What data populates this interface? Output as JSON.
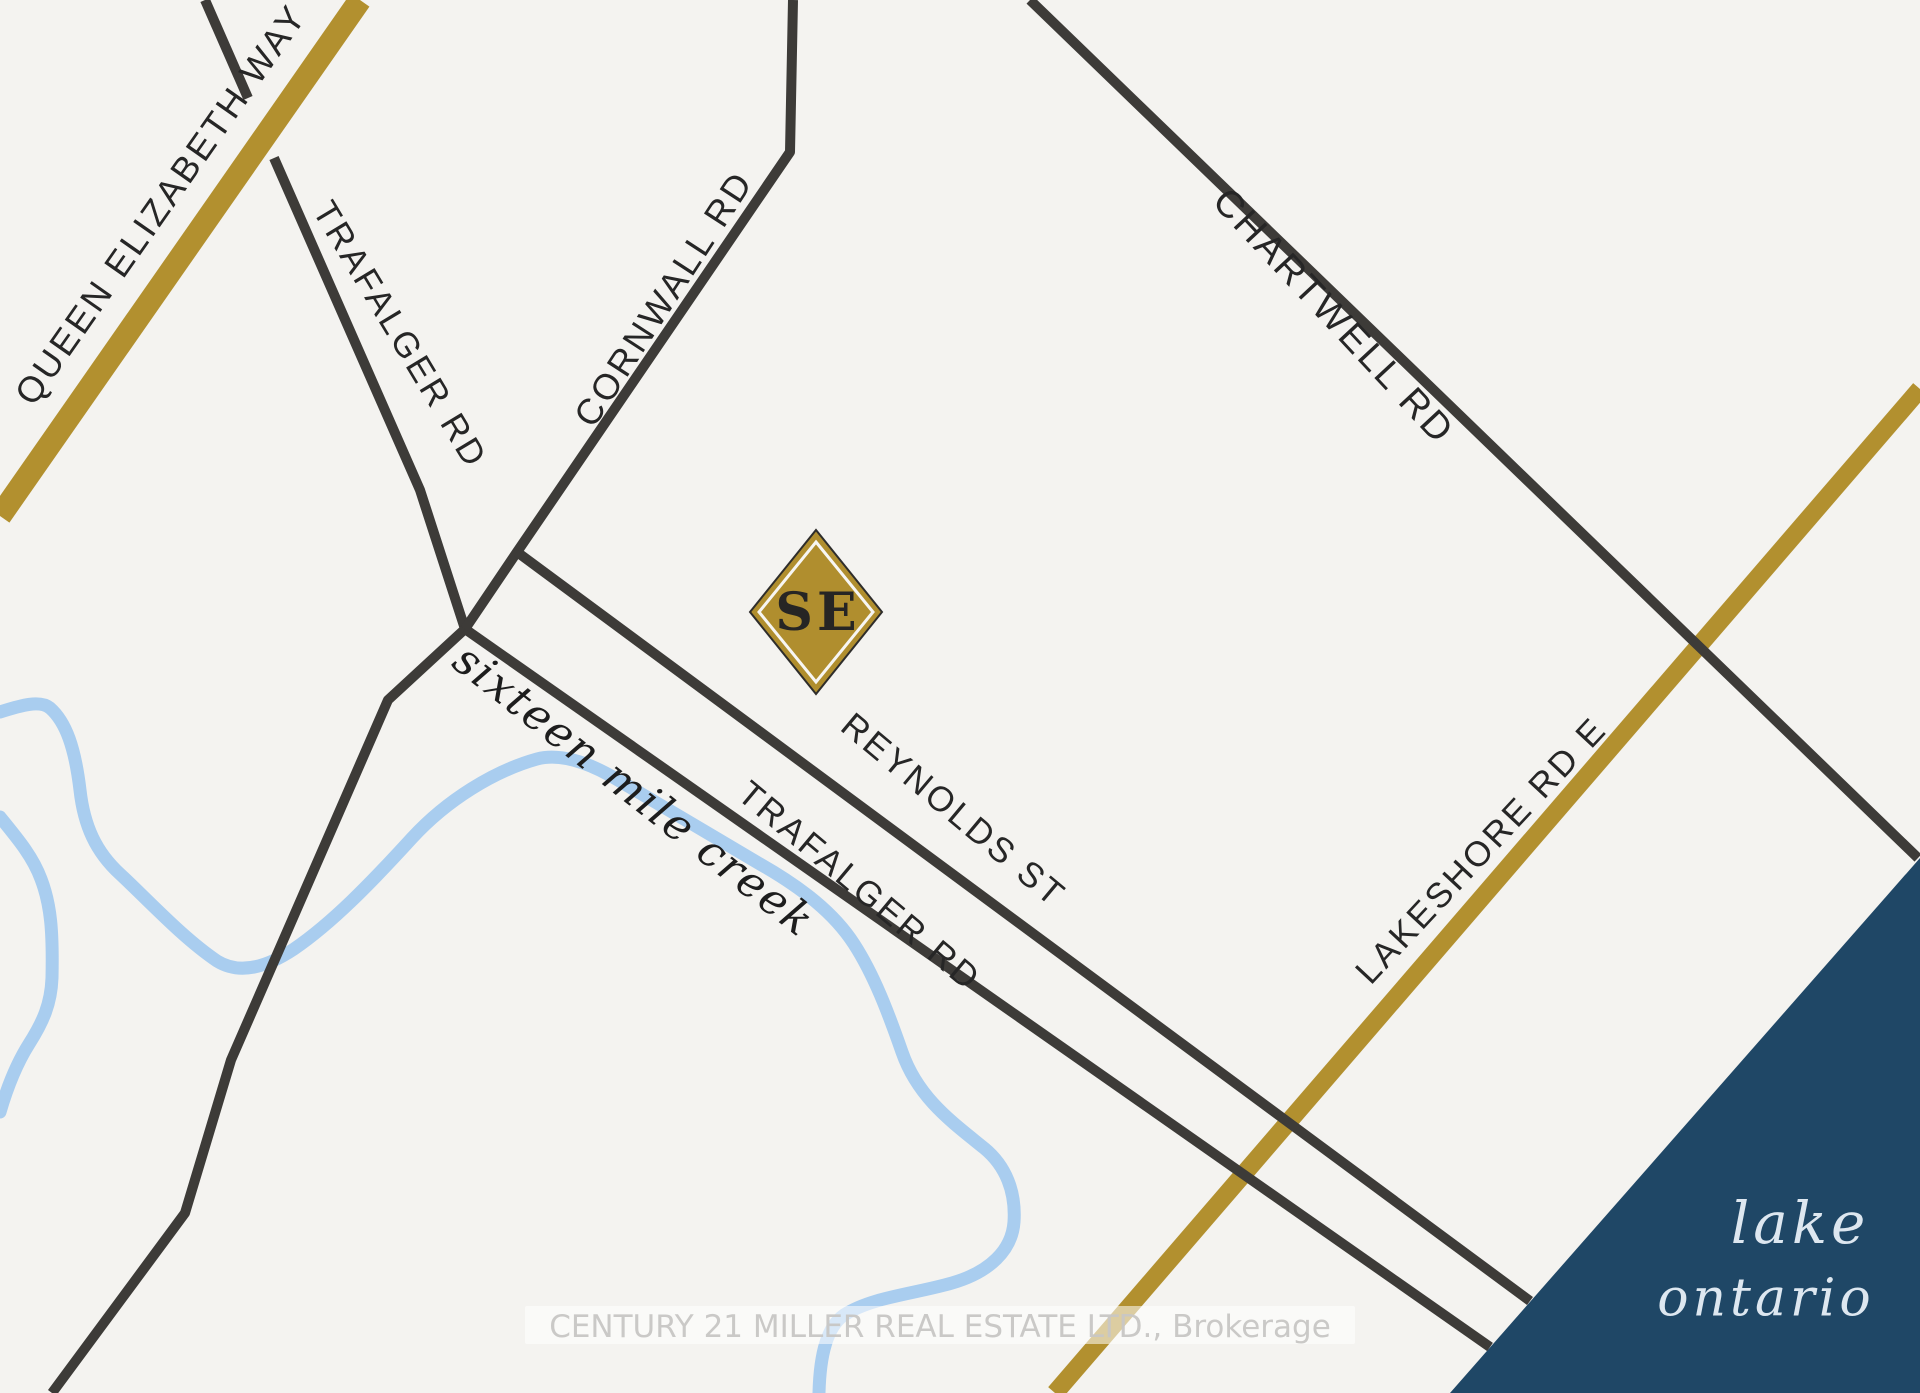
{
  "map": {
    "labels": {
      "qew": "QUEEN ELIZABETH WAY",
      "trafalgar_upper": "TRAFALGER RD",
      "cornwall": "CORNWALL RD",
      "chartwell": "CHARTWELL RD",
      "reynolds": "REYNOLDS ST",
      "trafalgar_lower": "TRAFALGER RD",
      "lakeshore": "LAKESHORE RD E",
      "creek": "sixteen mile creek",
      "lake_line1": "lake",
      "lake_line2": "ontario",
      "marker": "SE"
    },
    "watermark": "CENTURY 21 MILLER REAL ESTATE LTD., Brokerage",
    "colors": {
      "background": "#f4f3f0",
      "road_dark": "#3d3b38",
      "road_gold": "#b2902f",
      "creek_blue": "#a9cdef",
      "lake_navy": "#1f4766",
      "marker_gold": "#b08e2e",
      "label_dark": "#262626",
      "watermark_gray": "#c8c7c5"
    }
  }
}
